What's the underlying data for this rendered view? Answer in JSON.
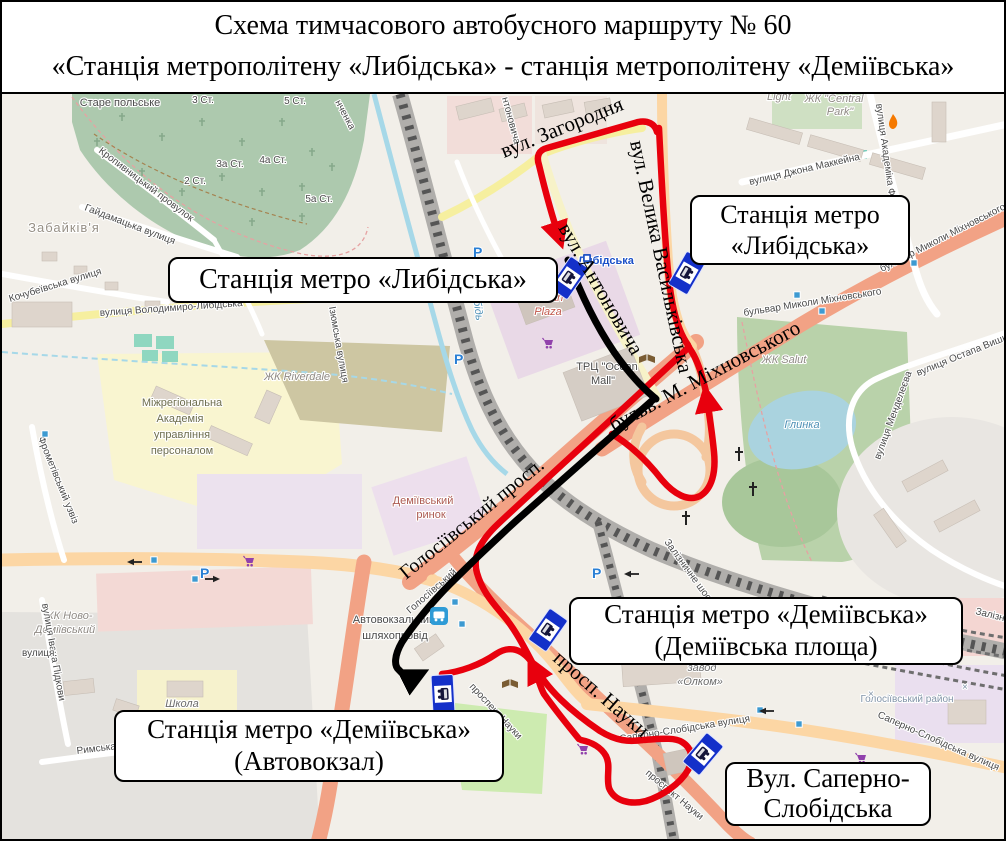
{
  "title": {
    "line1": "Схема тимчасового автобусного маршруту № 60",
    "line2": "«Станція метрополітену «Либідська» - станція метрополітену «Деміївська»"
  },
  "callouts": {
    "lybidska_left": {
      "text": "Станція метро «Либідська»"
    },
    "lybidska_right": {
      "line1": "Станція метро",
      "line2": "«Либідська»"
    },
    "demiivska_square": {
      "line1": "Станція метро «Деміївська»",
      "line2": "(Деміївська площа)"
    },
    "demiivska_bus": {
      "line1": "Станція метро «Деміївська»",
      "line2": "(Автовокзал)"
    },
    "saperno": {
      "line1": "Вул. Саперно-",
      "line2": "Слобідська"
    }
  },
  "route_labels": [
    "вул. Загородня",
    "вул. Велика Васильківська",
    "вул. Антоновича",
    "бульв. М. Міхновського",
    "Голосіївський просп.",
    "просп. Науки"
  ],
  "map_labels": [
    "Старе польське",
    "3 Ст.",
    "5 Ст.",
    "2 Ст.",
    "3а Ст.",
    "4а Ст.",
    "5а Ст.",
    "Забайків'я",
    "Кропивницький провулок",
    "Гайдамацька вулиця",
    "Кочубеївська вулиця",
    "вулиця Володимиро-Либідська",
    "Ізюмська вулиця",
    "Либідь",
    "Либідська",
    "Ocean",
    "Plaza",
    "ТРЦ \"Ocean",
    "Mall\"",
    "Деміївський",
    "ринок",
    "Міжрегіональна",
    "Академія",
    "управління",
    "персоналом",
    "ЖК Riverdale",
    "Фрометівський узвіз",
    "ЖК Ново-",
    "Деміївський",
    "вулиця Івана Підкови",
    "Римська",
    "вулиця",
    "Школа",
    "Автовокзальний",
    "шляхопровід",
    "Голосіївський",
    "проспект Науки",
    "проспект Науки",
    "завод",
    "«Олком»",
    "Саперно-Слобідська вулиця",
    "Саперно-Слобідська вулиця",
    "Голосіївський район",
    "Залізничне шосе",
    "Глинка",
    "ЖК Salut",
    "вулиця Менделеєва",
    "вулиця Остапа Вишні",
    "бульвар Миколи Міхновського",
    "бульвар Миколи Міхновського",
    "вулиця Джона Маккейна",
    "вулиця Академіка Філатова",
    "ЖК \"Central",
    "Park\"",
    "Light",
    "нченка",
    "нтоновича",
    "P",
    "P",
    "P",
    "P",
    "×",
    "×",
    "Залізн"
  ],
  "icons": {
    "bus_stop_sign": "blue road-sign with white square and bus pictogram",
    "bus_station_icon": "blue rounded square with white bus",
    "parking_icon": "blue letter P",
    "shopping_cart_icon": "purple cart",
    "fire_icon": "orange flame",
    "book_icon": "brown open book",
    "metro_icon": "blue square",
    "transit_stop_icon": "small blue square",
    "cemetery_cross_icon": "green cross",
    "church_cross_icon": "black cross",
    "oneway_arrow_icon": "small black arrow"
  },
  "colors": {
    "route_red": "#e8000d",
    "route_black": "#000000",
    "callout_border": "#000000",
    "callout_background": "#ffffff",
    "bus_sign_blue": "#1430c9",
    "water_blue": "#aad3df",
    "cemetery_green": "#adc9ae",
    "road_trunk_salmon": "#f2a285",
    "road_primary_orange": "#fcd6a4",
    "road_secondary_yellow": "#f6ef9f",
    "railway_gray": "#9a9a9a"
  }
}
